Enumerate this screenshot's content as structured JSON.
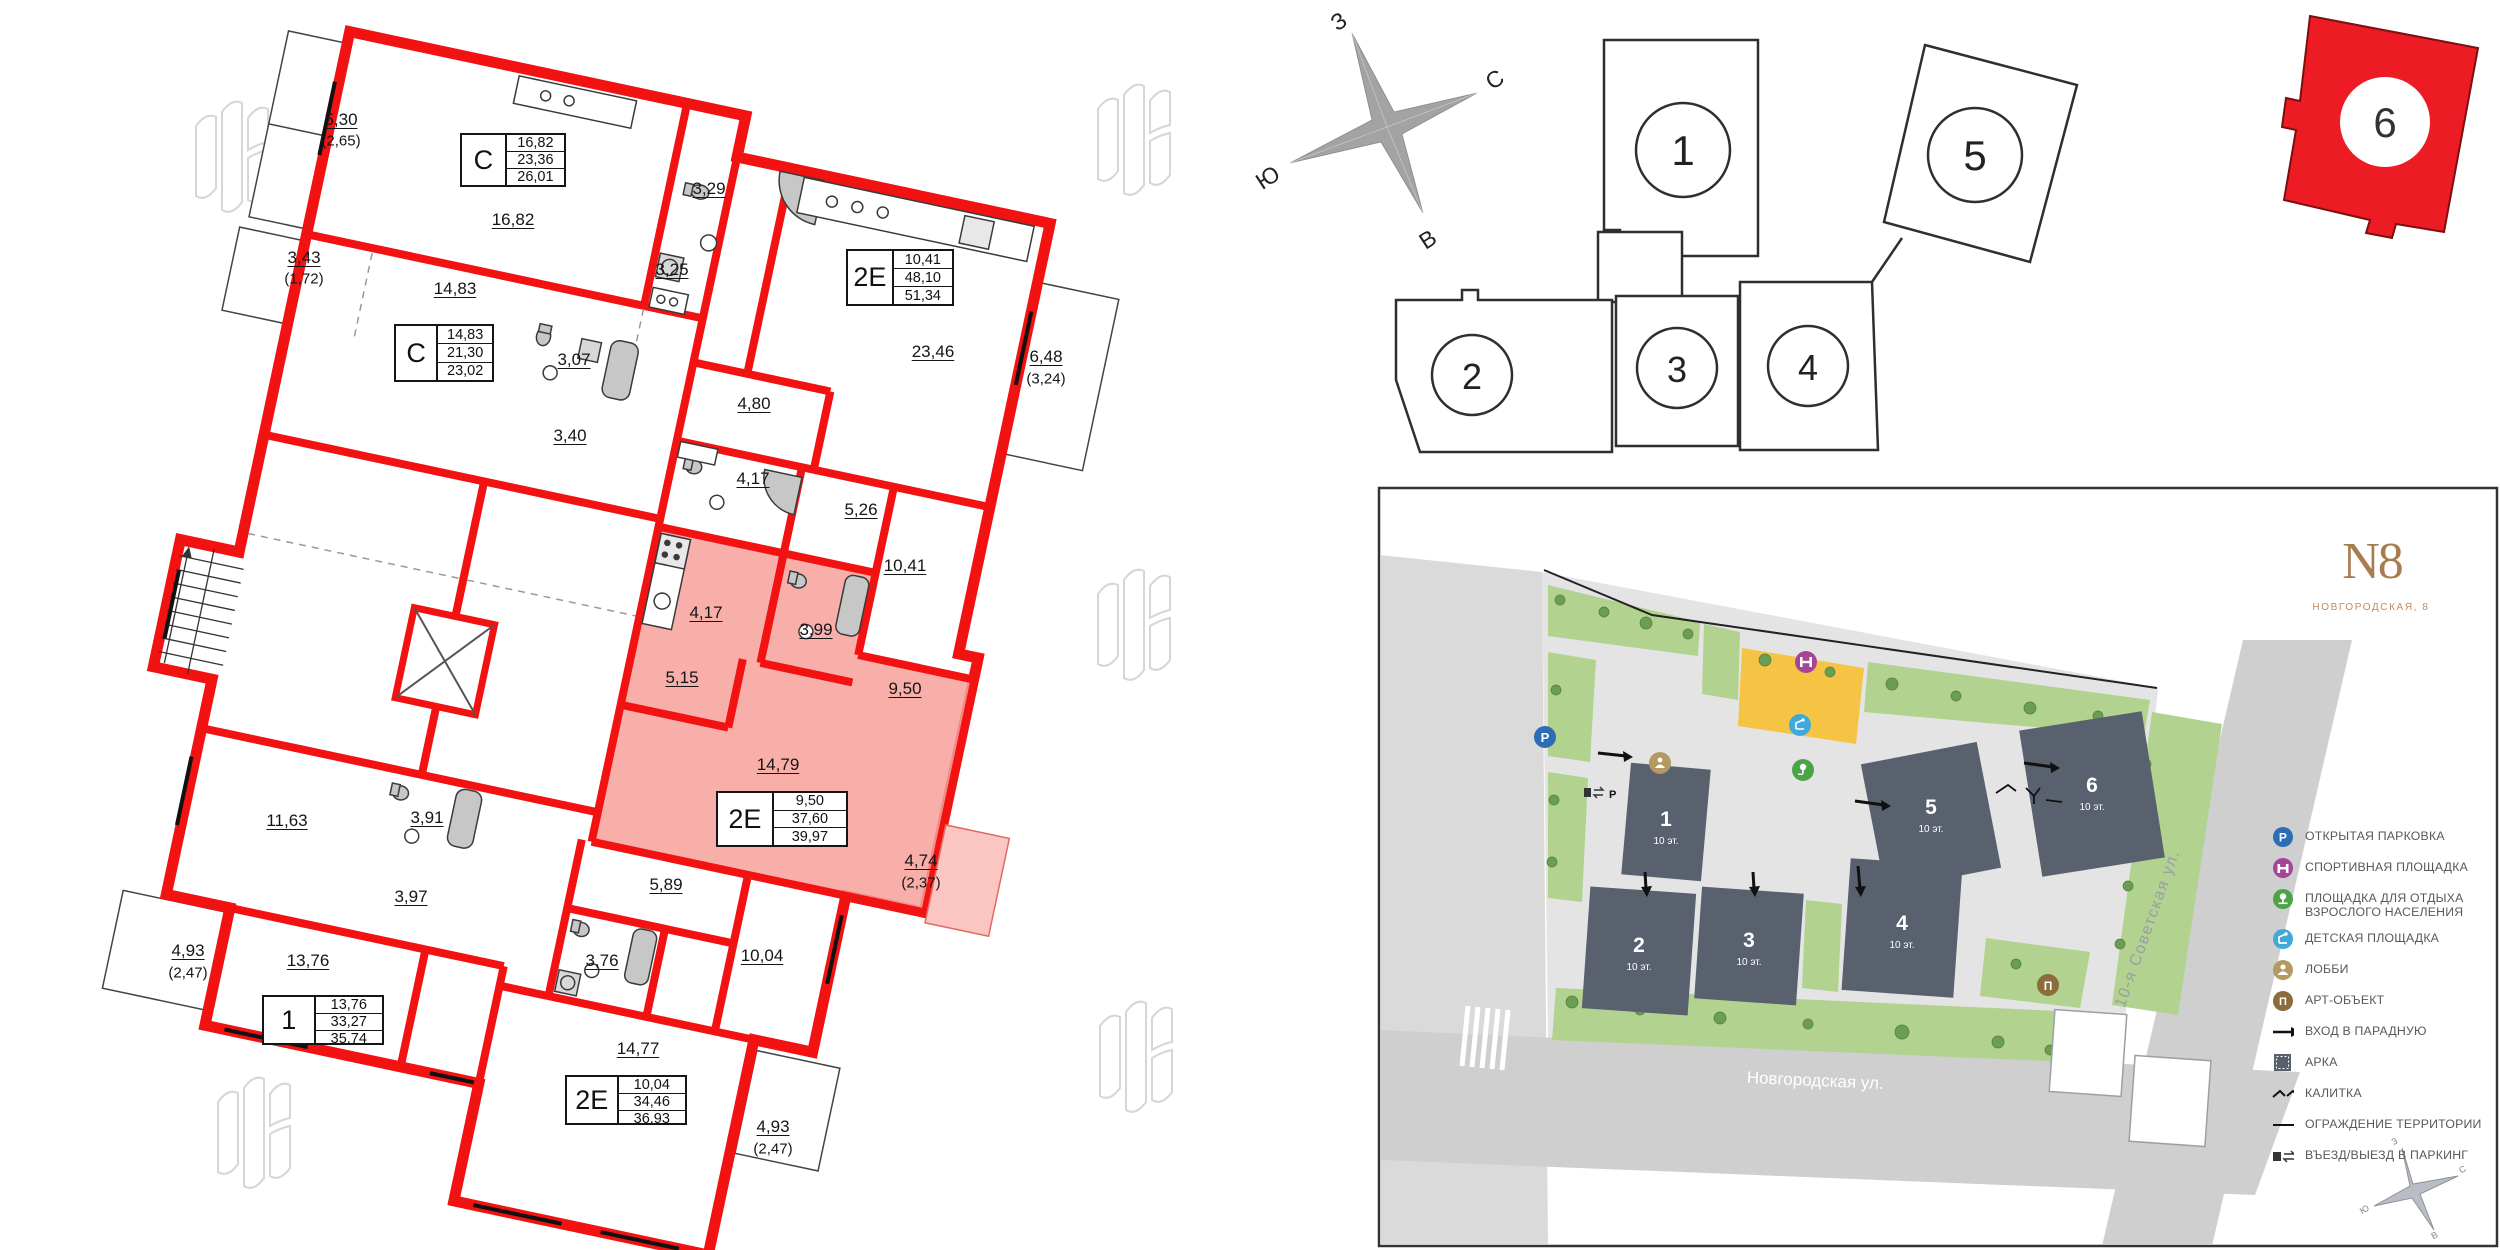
{
  "floorplan": {
    "rooms": [
      "5,30",
      "(2,65)",
      "3,43",
      "(1,72)",
      "16,82",
      "14,83",
      "3,29",
      "3,25",
      "3,07",
      "3,40",
      "4,80",
      "23,46",
      "6,48",
      "(3,24)",
      "4,17",
      "5,26",
      "10,41",
      "4,17",
      "3,99",
      "5,15",
      "9,50",
      "14,79",
      "4,74",
      "(2,37)",
      "11,63",
      "3,91",
      "3,97",
      "13,76",
      "4,93",
      "(2,47)",
      "5,89",
      "3,76",
      "10,04",
      "14,77",
      "4,93",
      "(2,47)"
    ],
    "units": [
      {
        "type": "С",
        "living": "16,82",
        "area": "23,36",
        "total": "26,01"
      },
      {
        "type": "С",
        "living": "14,83",
        "area": "21,30",
        "total": "23,02"
      },
      {
        "type": "2Е",
        "living": "10,41",
        "area": "48,10",
        "total": "51,34"
      },
      {
        "type": "2Е",
        "living": "9,50",
        "area": "37,60",
        "total": "39,97",
        "highlighted": true
      },
      {
        "type": "1",
        "living": "13,76",
        "area": "33,27",
        "total": "35,74"
      },
      {
        "type": "2Е",
        "living": "10,04",
        "area": "34,46",
        "total": "36,93"
      }
    ]
  },
  "compass": {
    "west": "З",
    "north": "С",
    "south": "Ю",
    "east": "В"
  },
  "sections": {
    "numbers": [
      "1",
      "2",
      "3",
      "4",
      "5"
    ],
    "highlighted_number": "6"
  },
  "masterplan": {
    "logo": "N8",
    "logo_subtitle": "НОВГОРОДСКАЯ, 8",
    "buildings": [
      {
        "number": "1",
        "floors": "10 эт."
      },
      {
        "number": "2",
        "floors": "10 эт."
      },
      {
        "number": "3",
        "floors": "10 эт."
      },
      {
        "number": "4",
        "floors": "10 эт."
      },
      {
        "number": "5",
        "floors": "10 эт."
      },
      {
        "number": "6",
        "floors": "10 эт."
      }
    ],
    "streets": {
      "bottom": "Новгородская ул.",
      "right": "10-я Советская ул."
    },
    "legend": [
      {
        "icon": "parking-icon",
        "label": "ОТКРЫТАЯ ПАРКОВКА"
      },
      {
        "icon": "sport-icon",
        "label": "СПОРТИВНАЯ ПЛОЩАДКА"
      },
      {
        "icon": "adult-rest-icon",
        "label": "ПЛОЩАДКА ДЛЯ ОТДЫХА ВЗРОСЛОГО НАСЕЛЕНИЯ"
      },
      {
        "icon": "kids-icon",
        "label": "ДЕТСКАЯ ПЛОЩАДКА"
      },
      {
        "icon": "lobby-icon",
        "label": "ЛОББИ"
      },
      {
        "icon": "art-icon",
        "label": "АРТ-ОБЪЕКТ"
      },
      {
        "icon": "entrance-arrow-icon",
        "label": "ВХОД В ПАРАДНУЮ"
      },
      {
        "icon": "arch-icon",
        "label": "АРКА"
      },
      {
        "icon": "gate-icon",
        "label": "КАЛИТКА"
      },
      {
        "icon": "fence-icon",
        "label": "ОГРАЖДЕНИЕ ТЕРРИТОРИИ"
      },
      {
        "icon": "parking-entry-icon",
        "label": "ВЪЕЗД/ВЫЕЗД В ПАРКИНГ"
      }
    ],
    "art_letter": "П",
    "parking_letter": "P"
  },
  "colors": {
    "wall_red": "#f21212",
    "highlight_pink": "#f7a09a",
    "section_red": "#ec1b24",
    "building_gray": "#59616f",
    "green": "#b2d28f",
    "playground_yellow": "#f5c445",
    "logo_brown": "#a87c4f"
  }
}
